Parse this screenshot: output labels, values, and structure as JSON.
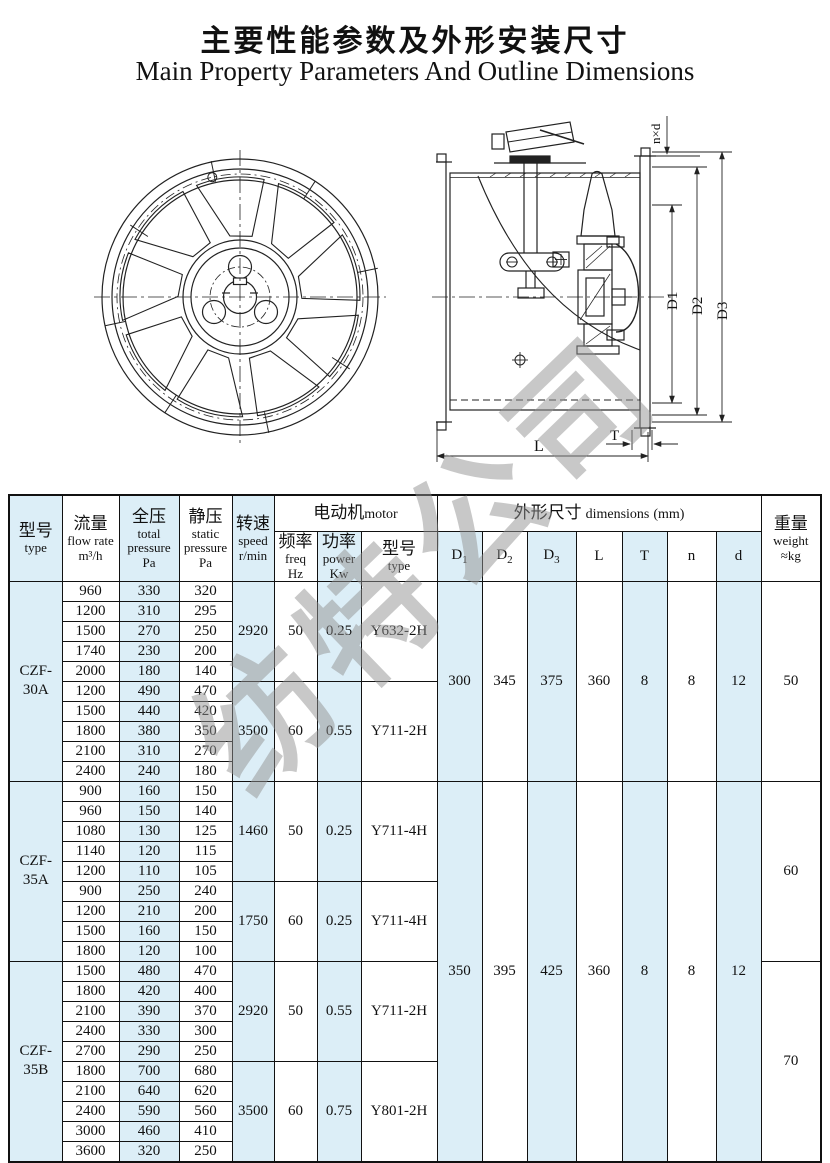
{
  "page": {
    "title_zh": "主要性能参数及外形安装尺寸",
    "title_en": "Main Property Parameters And Outline Dimensions"
  },
  "watermark": {
    "text": "纺特公司"
  },
  "diagram": {
    "labels": {
      "nxd": "n×d",
      "d1": "D1",
      "d2": "D2",
      "d3": "D3",
      "l": "L",
      "t": "T"
    }
  },
  "table": {
    "header": {
      "type": {
        "zh": "型号",
        "en": "type"
      },
      "flow": {
        "zh": "流量",
        "en": "flow rate",
        "unit": "m³/h"
      },
      "total_pressure": {
        "zh": "全压",
        "en1": "total",
        "en2": "pressure",
        "unit": "Pa"
      },
      "static_pressure": {
        "zh": "静压",
        "en1": "static",
        "en2": "pressure",
        "unit": "Pa"
      },
      "speed": {
        "zh": "转速",
        "en": "speed",
        "unit": "r/min"
      },
      "motor_group": {
        "zh": "电动机",
        "en": "motor"
      },
      "freq": {
        "zh": "频率",
        "en": "freq",
        "unit": "Hz"
      },
      "power": {
        "zh": "功率",
        "en": "power",
        "unit": "Kw"
      },
      "motor_type": {
        "zh": "型号",
        "en": "type"
      },
      "dims_group": {
        "zh": "外形尺寸",
        "en": "dimensions",
        "unit": "(mm)"
      },
      "d1": {
        "main": "D",
        "sub": "1"
      },
      "d2": {
        "main": "D",
        "sub": "2"
      },
      "d3": {
        "main": "D",
        "sub": "3"
      },
      "l": "L",
      "t": "T",
      "n": "n",
      "d": "d",
      "weight": {
        "zh": "重量",
        "en": "weight",
        "unit": "≈kg"
      }
    },
    "groups": [
      {
        "type": "CZF-30A",
        "weight": "50",
        "dims": [
          "300",
          "345",
          "375",
          "360",
          "8",
          "8",
          "12"
        ],
        "subgroups": [
          {
            "speed": "2920",
            "freq": "50",
            "power": "0.25",
            "motor": "Y632-2H",
            "rows": [
              [
                "960",
                "330",
                "320"
              ],
              [
                "1200",
                "310",
                "295"
              ],
              [
                "1500",
                "270",
                "250"
              ],
              [
                "1740",
                "230",
                "200"
              ],
              [
                "2000",
                "180",
                "140"
              ]
            ]
          },
          {
            "speed": "3500",
            "freq": "60",
            "power": "0.55",
            "motor": "Y711-2H",
            "rows": [
              [
                "1200",
                "490",
                "470"
              ],
              [
                "1500",
                "440",
                "420"
              ],
              [
                "1800",
                "380",
                "350"
              ],
              [
                "2100",
                "310",
                "270"
              ],
              [
                "2400",
                "240",
                "180"
              ]
            ]
          }
        ]
      },
      {
        "type": "CZF-35A",
        "weight": "60",
        "dims": [
          "350",
          "395",
          "425",
          "360",
          "8",
          "8",
          "12"
        ],
        "subgroups": [
          {
            "speed": "1460",
            "freq": "50",
            "power": "0.25",
            "motor": "Y711-4H",
            "rows": [
              [
                "900",
                "160",
                "150"
              ],
              [
                "960",
                "150",
                "140"
              ],
              [
                "1080",
                "130",
                "125"
              ],
              [
                "1140",
                "120",
                "115"
              ],
              [
                "1200",
                "110",
                "105"
              ]
            ]
          },
          {
            "speed": "1750",
            "freq": "60",
            "power": "0.25",
            "motor": "Y711-4H",
            "rows": [
              [
                "900",
                "250",
                "240"
              ],
              [
                "1200",
                "210",
                "200"
              ],
              [
                "1500",
                "160",
                "150"
              ],
              [
                "1800",
                "120",
                "100"
              ]
            ]
          }
        ]
      },
      {
        "type": "CZF-35B",
        "weight": "70",
        "dims": null,
        "subgroups": [
          {
            "speed": "2920",
            "freq": "50",
            "power": "0.55",
            "motor": "Y711-2H",
            "rows": [
              [
                "1500",
                "480",
                "470"
              ],
              [
                "1800",
                "420",
                "400"
              ],
              [
                "2100",
                "390",
                "370"
              ],
              [
                "2400",
                "330",
                "300"
              ],
              [
                "2700",
                "290",
                "250"
              ]
            ]
          },
          {
            "speed": "3500",
            "freq": "60",
            "power": "0.75",
            "motor": "Y801-2H",
            "rows": [
              [
                "1800",
                "700",
                "680"
              ],
              [
                "2100",
                "640",
                "620"
              ],
              [
                "2400",
                "590",
                "560"
              ],
              [
                "3000",
                "460",
                "410"
              ],
              [
                "3600",
                "320",
                "250"
              ]
            ]
          }
        ]
      }
    ]
  }
}
